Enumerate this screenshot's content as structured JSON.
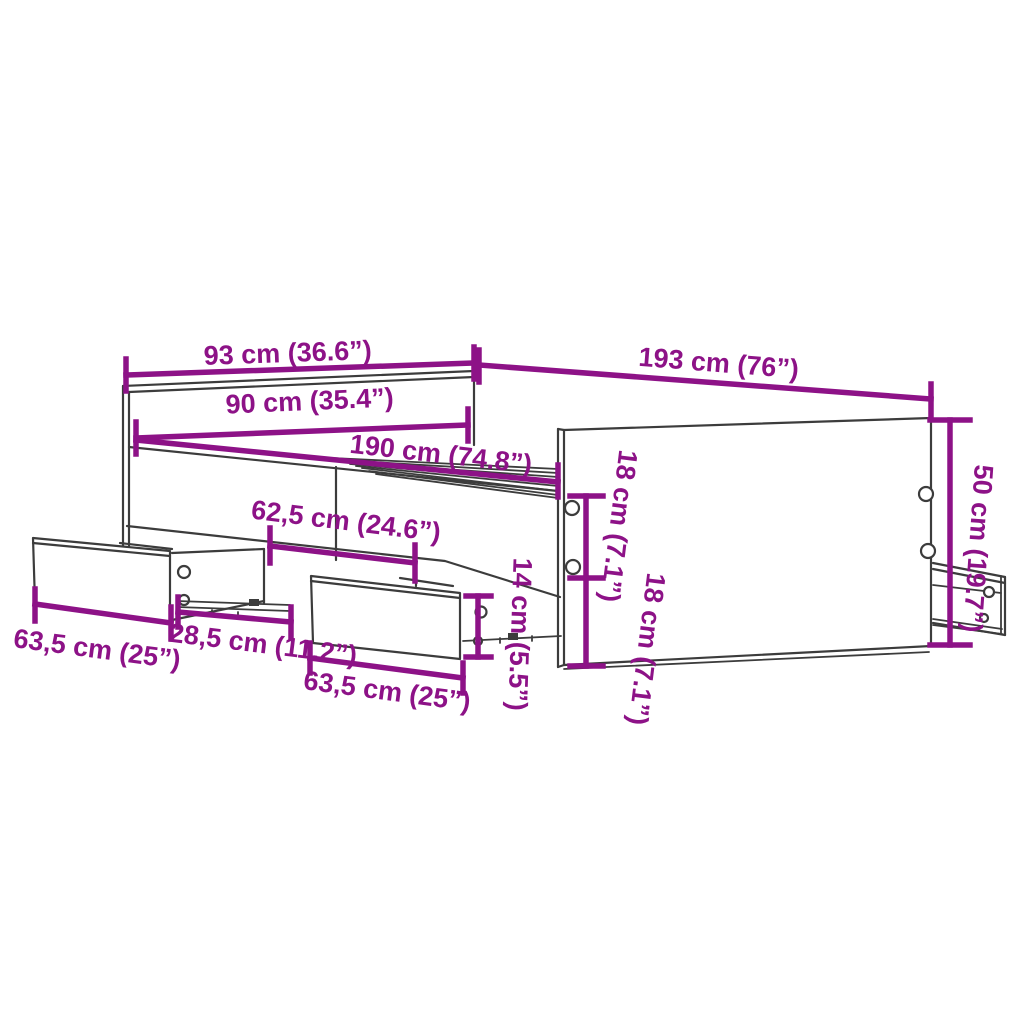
{
  "diagram": {
    "type": "furniture dimension diagram",
    "subject": "bed frame with headboard, slatted base and storage drawers",
    "accent_color": "#8D1287",
    "line_color": "#3C3C3C",
    "background_color": "#FFFFFF",
    "dimensions": [
      {
        "id": "headboard-width",
        "label": "93 cm (36.6”)",
        "cm": "93",
        "inch": "36.6"
      },
      {
        "id": "frame-length",
        "label": "193 cm (76”)",
        "cm": "193",
        "inch": "76"
      },
      {
        "id": "inner-width",
        "label": "90 cm (35.4”)",
        "cm": "90",
        "inch": "35.4"
      },
      {
        "id": "slat-base-length",
        "label": "190 cm (74.8”)",
        "cm": "190",
        "inch": "74.8"
      },
      {
        "id": "middle-drawer-opening",
        "label": "62,5 cm (24.6”)",
        "cm": "62,5",
        "inch": "24.6"
      },
      {
        "id": "left-drawer-width",
        "label": "63,5 cm (25”)",
        "cm": "63,5",
        "inch": "25"
      },
      {
        "id": "drawer-extension-depth",
        "label": "28,5 cm (11.2”)",
        "cm": "28,5",
        "inch": "11.2"
      },
      {
        "id": "middle-drawer-width",
        "label": "63,5 cm (25”)",
        "cm": "63,5",
        "inch": "25"
      },
      {
        "id": "drawer-front-height",
        "label": "14 cm (5.5”)",
        "cm": "14",
        "inch": "5.5"
      },
      {
        "id": "side-rail-height-upper",
        "label": "18 cm (7.1”)",
        "cm": "18",
        "inch": "7.1"
      },
      {
        "id": "side-rail-height-lower",
        "label": "18 cm (7.1”)",
        "cm": "18",
        "inch": "7.1"
      },
      {
        "id": "side-panel-height",
        "label": "50 cm (19.7”)",
        "cm": "50",
        "inch": "19.7"
      }
    ]
  }
}
